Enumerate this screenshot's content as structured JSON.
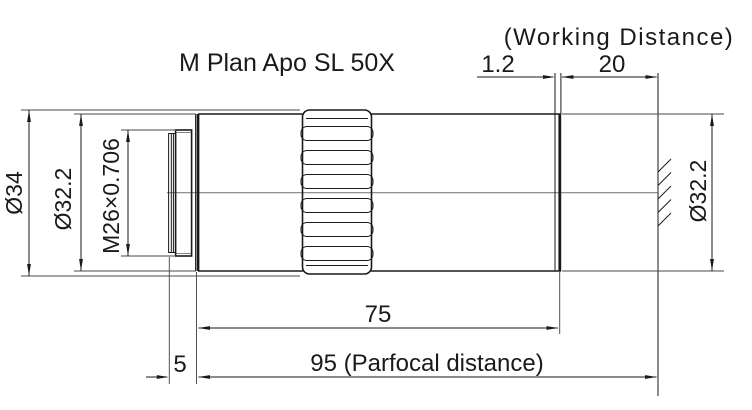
{
  "title": "M Plan Apo SL 50X",
  "labels": {
    "working_distance": "(Working Distance)"
  },
  "dims": {
    "lens_recess": "1.2",
    "working_distance": "20",
    "barrel_length": "75",
    "parfocal_distance": "95 (Parfocal distance)",
    "thread_length": "5",
    "knurl_diameter": "Ø34",
    "rear_barrel_diameter": "Ø32.2",
    "thread_spec": "M26×0.706",
    "front_barrel_diameter": "Ø32.2"
  },
  "colors": {
    "background": "#ffffff",
    "object_line": "#1a1a1a",
    "extension_line": "#4a4a4a",
    "centerline": "#808080"
  }
}
